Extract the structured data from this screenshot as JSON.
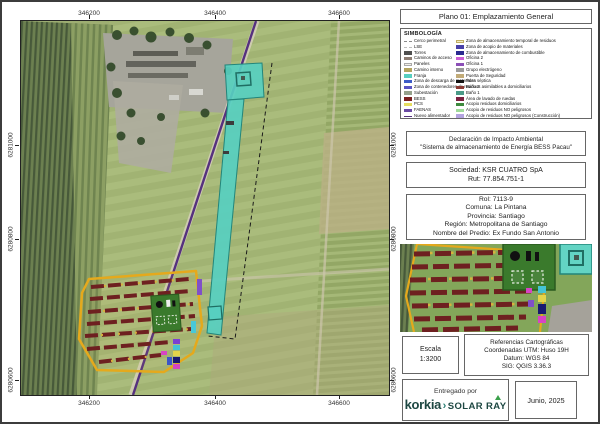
{
  "header": {
    "title": "Plano 01: Emplazamiento General"
  },
  "map": {
    "axis": {
      "top": [
        "346200",
        "346400",
        "346600"
      ],
      "bottom": [
        "346200",
        "346400",
        "346600"
      ],
      "left": [
        "6281000",
        "6280800",
        "6280600"
      ],
      "right": [
        "6281000",
        "6280800",
        "6280600"
      ]
    }
  },
  "legend": {
    "title": "SIMBOLOGÍA",
    "left": [
      {
        "label": "Cerco perimetral",
        "type": "dash",
        "color": "#8a8a8a"
      },
      {
        "label": "LSE",
        "type": "dash",
        "color": "#bdbdbd"
      },
      {
        "label": "Torres",
        "color": "#4f4f4f"
      },
      {
        "label": "Caminos de acceso",
        "color": "#8d7d74"
      },
      {
        "label": "Paneles",
        "color": "#f2efe6",
        "border": "#aaaaaa"
      },
      {
        "label": "Camino interno",
        "color": "#b3a45e"
      },
      {
        "label": "Franja",
        "color": "#57cfc0"
      },
      {
        "label": "Zona de descarga de materiales",
        "color": "#3d5cc8"
      },
      {
        "label": "Zona de contenedores de residuos asimilables a domiciliarios",
        "color": "#5a55c4"
      },
      {
        "label": "Subestación",
        "color": "#95a18c"
      },
      {
        "label": "BESS",
        "color": "#7a1f1f"
      },
      {
        "label": "PCS",
        "color": "#e6dd60"
      },
      {
        "label": "FAENAS",
        "color": "#6a4aa4"
      },
      {
        "label": "Nuevo alimentador",
        "type": "line",
        "color": "#55317e"
      }
    ],
    "right": [
      {
        "label": "Zona de almacenamiento temporal de residuos",
        "color": "#f0ecc8",
        "border": "#c0ae62"
      },
      {
        "label": "Zona de acopio de materiales",
        "color": "#4840a8"
      },
      {
        "label": "Zona de almacenamiento de combustible",
        "color": "#2a2a90"
      },
      {
        "label": "Oficina 2",
        "color": "#cc5fd4"
      },
      {
        "label": "Oficina 1",
        "color": "#8c4fb8"
      },
      {
        "label": "Grupo electrógeno",
        "color": "#9a9a9a"
      },
      {
        "label": "Puerta de Seguridad",
        "color": "#c2ab78"
      },
      {
        "label": "Poza séptica",
        "color": "#141414"
      },
      {
        "label": "Baño 2",
        "color": "#8a3a34"
      },
      {
        "label": "Baño 1",
        "color": "#4a9a88"
      },
      {
        "label": "Área de lavado de ruedas",
        "color": "#7a2040"
      },
      {
        "label": "Acopio residuos domiciliarios",
        "color": "#3e8a3e"
      },
      {
        "label": "Acopio de residuos NO peligrosos",
        "color": "#a0dc9a"
      },
      {
        "label": "Acopio de residuos NO peligrosos (Construcción)",
        "color": "#b4a4e0"
      }
    ]
  },
  "declaration": {
    "line1": "Declaración de Impacto Ambiental",
    "line2": "\"Sistema de almacenamiento de Energía BESS Pacau\""
  },
  "company": {
    "sociedad": "Sociedad: KSR CUATRO SpA",
    "rut": "Rut: 77.854.751-1"
  },
  "property": {
    "rol": "Rol: 7113-9",
    "comuna": "Comuna: La Pintana",
    "provincia": "Provincia: Santiago",
    "region": "Región: Metropolitana de Santiago",
    "predio": "Nombre del Predio: Ex Fundo San Antonio"
  },
  "scale": {
    "label": "Escala",
    "value": "1:3200"
  },
  "references": {
    "line1": "Referencias Cartográficas",
    "line2": "Coordenadas UTM: Huso 19H",
    "line3": "Datum: WGS 84",
    "line4": "SIG: QGIS 3.36.3"
  },
  "delivery": {
    "label": "Entregado por",
    "brand1": "korkia",
    "separator": "›",
    "brand2": "SOLAR RAY"
  },
  "date": {
    "value": "Junio, 2025"
  },
  "colors": {
    "franja_strip": "#57cfc0",
    "pv_boundary": "#e5a91c",
    "bess_rows": "#6e2020",
    "lse_line": "#55317e"
  }
}
